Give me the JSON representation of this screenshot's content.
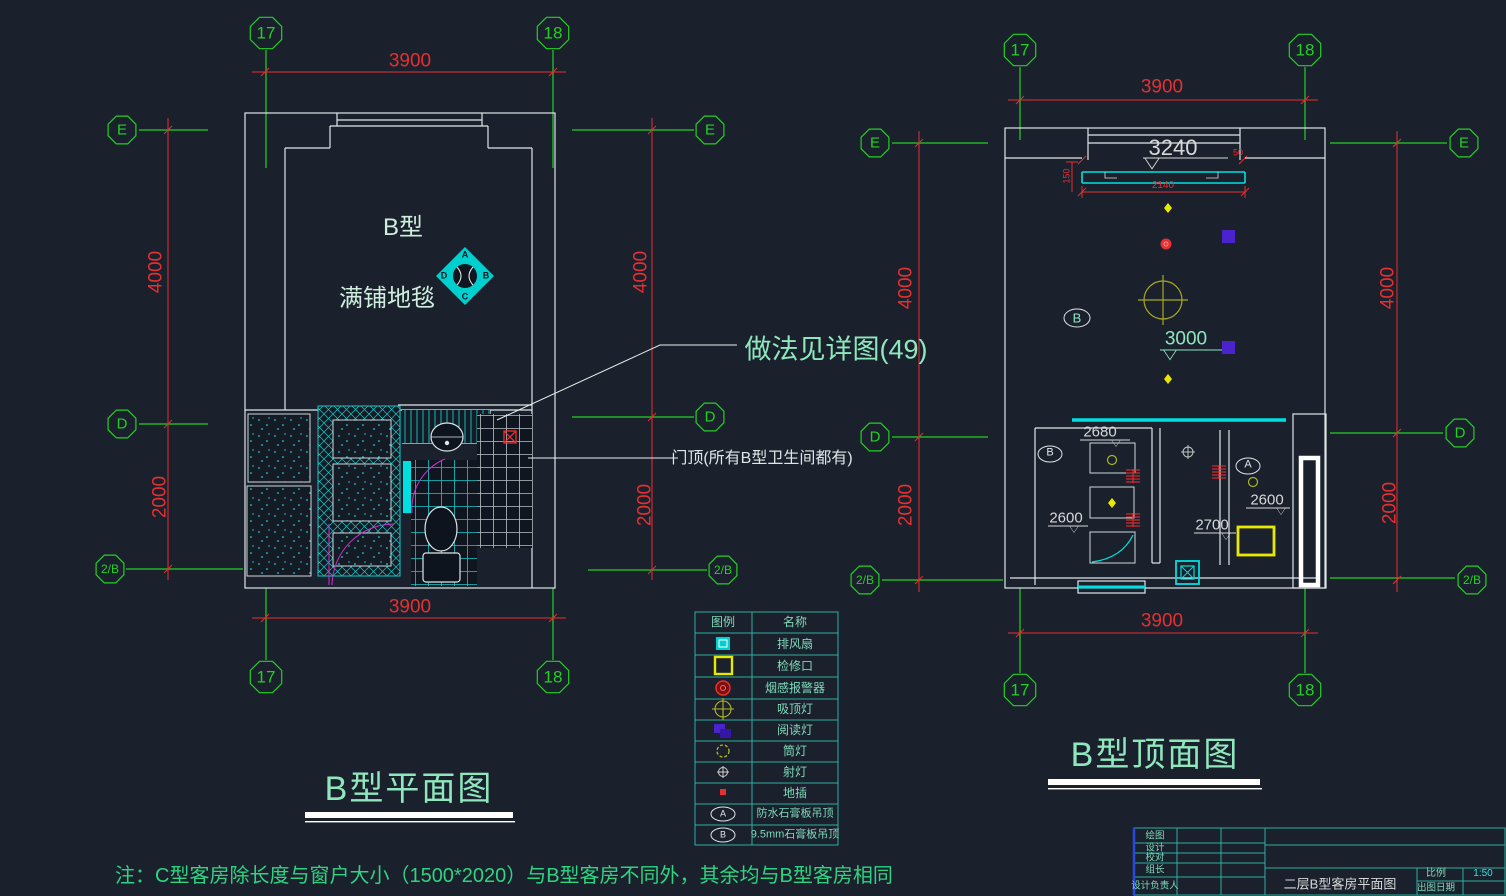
{
  "app": {
    "background": "#1a212d"
  },
  "grid": {
    "col_17": "17",
    "col_18": "18",
    "row_e": "E",
    "row_d": "D",
    "row_2b": "2/B"
  },
  "dims": {
    "width": "3900",
    "height_upper": "4000",
    "height_lower": "2000"
  },
  "left_plan": {
    "title": "B型平面图",
    "room_type": "B型",
    "floor_note": "满铺地毯",
    "compass": {
      "top": "A",
      "right": "B",
      "bottom": "C",
      "left": "D"
    },
    "detail_callout": "做法见详图(49)",
    "door_callout": "门顶(所有B型卫生间都有)"
  },
  "right_plan": {
    "title": "B型顶面图",
    "ceiling_heights": {
      "h3240": "3240",
      "h3000": "3000",
      "h2680": "2680",
      "h2600_closet": "2600",
      "h2700": "2700",
      "h2600_bath": "2600"
    },
    "curtain_dims": {
      "w2140": "2140",
      "d150": "150",
      "d50": "50"
    },
    "zones": {
      "b_room": "B",
      "b_closet": "B",
      "a_bath": "A"
    }
  },
  "legend": {
    "header": {
      "symbol": "图例",
      "name": "名称"
    },
    "rows": [
      {
        "name": "排风扇"
      },
      {
        "name": "检修口"
      },
      {
        "name": "烟感报警器"
      },
      {
        "name": "吸顶灯"
      },
      {
        "name": "阅读灯"
      },
      {
        "name": "筒灯"
      },
      {
        "name": "射灯"
      },
      {
        "name": "地插"
      },
      {
        "label": "A",
        "name": "防水石膏板吊顶"
      },
      {
        "label": "B",
        "name": "9.5mm石膏板吊顶"
      }
    ]
  },
  "note": "注：C型客房除长度与窗户大小（1500*2020）与B型客房不同外，其余均与B型客房相同",
  "title_block": {
    "rows": [
      "绘图",
      "设计",
      "校对",
      "组长",
      "设计负责人"
    ],
    "drawing_title": "二层B型客房平面图",
    "scale_label": "比例",
    "scale_value": "1:50",
    "date_label": "出图日期"
  }
}
